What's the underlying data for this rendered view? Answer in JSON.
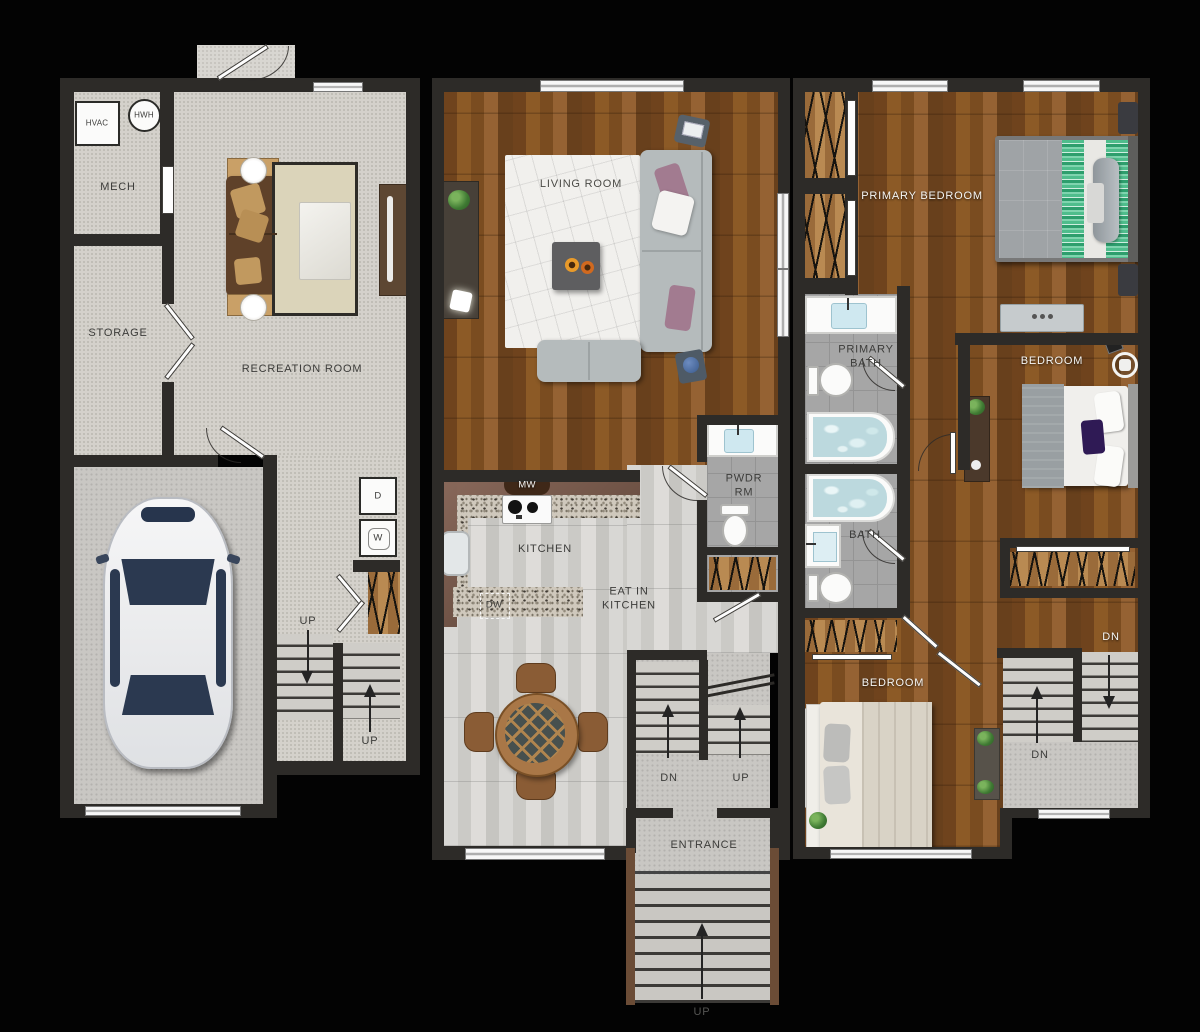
{
  "colors": {
    "background": "#030303",
    "wall": "#2d2b28",
    "carpet": "#d4d1cb",
    "concrete": "#c9c7c3",
    "wood_dark": "#7b4b21",
    "wood_light": "#d2d1ce",
    "granite": "#cfc8bc",
    "tile": "#a6a6a6",
    "water": "#bcd9de",
    "rail_wood": "#6b4c36",
    "bed_green_stripe": "#4fbd8c",
    "sofa_gray": "#b5bbbc",
    "couch_brown": "#5f4129"
  },
  "floors": {
    "lower": {
      "labels": {
        "hvac": "HVAC",
        "hwh": "HWH",
        "mech": "MECH",
        "storage": "STORAGE",
        "recreation": "RECREATION ROOM",
        "dryer": "D",
        "washer": "W",
        "up_left": "UP",
        "up_right": "UP"
      }
    },
    "main": {
      "labels": {
        "living": "LIVING ROOM",
        "mw": "MW",
        "kitchen": "KITCHEN",
        "dw": "DW",
        "eat_in": "EAT IN KITCHEN",
        "pwdr": "PWDR RM",
        "dn": "DN",
        "up": "UP",
        "entrance": "ENTRANCE",
        "entry_up": "UP"
      }
    },
    "upper": {
      "labels": {
        "primary_bedroom": "PRIMARY BEDROOM",
        "primary_bath": "PRIMARY BATH",
        "bedroom_mid": "BEDROOM",
        "bath": "BATH",
        "bedroom_rear": "BEDROOM",
        "dn_top": "DN",
        "dn_bottom": "DN"
      }
    }
  }
}
